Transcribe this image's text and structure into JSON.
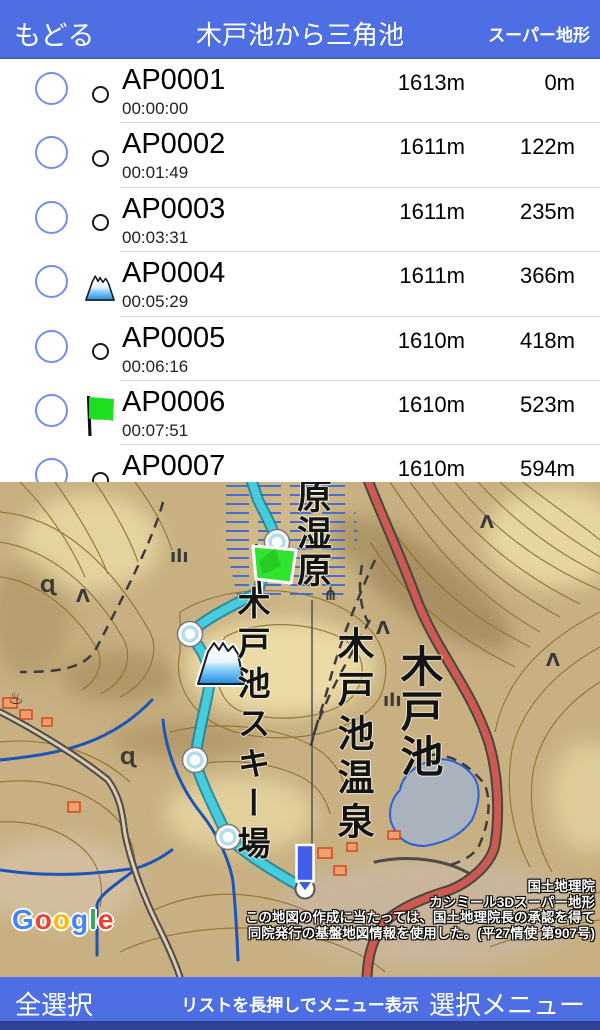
{
  "header": {
    "back": "もどる",
    "title": "木戸池から三角池",
    "right": "スーパー地形"
  },
  "list": {
    "rows": [
      {
        "name": "AP0001",
        "time": "00:00:00",
        "elevation": "1613m",
        "distance": "0m",
        "icon": "circle"
      },
      {
        "name": "AP0002",
        "time": "00:01:49",
        "elevation": "1611m",
        "distance": "122m",
        "icon": "circle"
      },
      {
        "name": "AP0003",
        "time": "00:03:31",
        "elevation": "1611m",
        "distance": "235m",
        "icon": "circle"
      },
      {
        "name": "AP0004",
        "time": "00:05:29",
        "elevation": "1611m",
        "distance": "366m",
        "icon": "mountain"
      },
      {
        "name": "AP0005",
        "time": "00:06:16",
        "elevation": "1610m",
        "distance": "418m",
        "icon": "circle"
      },
      {
        "name": "AP0006",
        "time": "00:07:51",
        "elevation": "1610m",
        "distance": "523m",
        "icon": "flag"
      },
      {
        "name": "AP0007",
        "elevation": "1610m",
        "distance": "594m",
        "icon": "circle"
      }
    ]
  },
  "map": {
    "labels": {
      "wetland": "原湿原",
      "ski_area": "木戸池スキー場",
      "onsen": "木戸池温泉",
      "lake": "木戸池"
    },
    "attribution": {
      "line1": "国土地理院",
      "line2": "カシミール3Dスーパー地形",
      "line3": "この地図の作成に当たっては、国土地理院長の承認を得て",
      "line4": "同院発行の基盤地図情報を使用した。(平27情使 第907号)"
    },
    "google": {
      "letters": [
        "G",
        "o",
        "o",
        "g",
        "l",
        "e"
      ]
    },
    "symbols": [
      {
        "glyph": "♨",
        "x": 8,
        "y": 222,
        "size": 30
      },
      {
        "glyph": "Λ",
        "x": 76,
        "y": 120
      },
      {
        "glyph": "Λ",
        "x": 480,
        "y": 46
      },
      {
        "glyph": "Λ",
        "x": 376,
        "y": 152
      },
      {
        "glyph": "Λ",
        "x": 546,
        "y": 184
      },
      {
        "glyph": "⋔",
        "x": 323,
        "y": 118
      },
      {
        "glyph": "ılı",
        "x": 383,
        "y": 224
      },
      {
        "glyph": "ılı",
        "x": 170,
        "y": 80
      },
      {
        "glyph": "Ɋ",
        "x": 40,
        "y": 110
      },
      {
        "glyph": "Ɋ",
        "x": 120,
        "y": 282
      }
    ]
  },
  "footer": {
    "select_all": "全選択",
    "hint": "リストを長押しでメニュー表示",
    "select_menu": "選択メニュー"
  },
  "colors": {
    "bar_blue": "#4d6fe3",
    "bar_dark_strip": "#2f4396",
    "selection_circle": "#6e8ef2",
    "track_cyan": "#46ccda",
    "flag_green": "#2fe32f",
    "pin_blue": "#3f5de8",
    "map_road_red": "#cd5a52",
    "lake_fill": "#a9b2bd",
    "stream_blue": "#1c55b8",
    "google_brand": [
      "#4285F4",
      "#EA4335",
      "#FBBC05",
      "#4285F4",
      "#34A853",
      "#EA4335"
    ]
  }
}
